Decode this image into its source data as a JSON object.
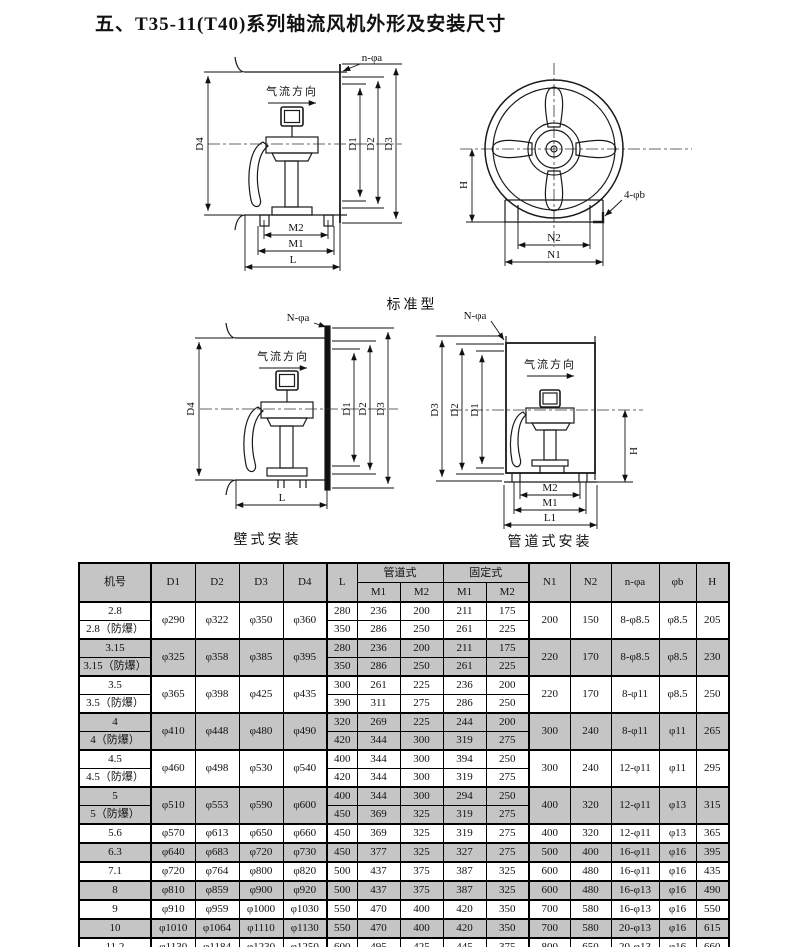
{
  "title": "五、T35-11(T40)系列轴流风机外形及安装尺寸",
  "colors": {
    "table_shade": "#c5c5c5",
    "line": "#111111"
  },
  "diagrams": {
    "airflow": "气流方向",
    "standard_caption": "标准型",
    "wall_caption": "壁式安装",
    "duct_caption": "管道式安装",
    "side": {
      "holes": "n-φa",
      "d4": "D4",
      "d1": "D1",
      "d2": "D2",
      "d3": "D3",
      "m2": "M2",
      "m1": "M1",
      "l": "L"
    },
    "front": {
      "holes": "4-φb",
      "h": "H",
      "n2": "N2",
      "n1": "N1"
    },
    "wall": {
      "holes": "N-φa",
      "d4": "D4",
      "d1": "D1",
      "d2": "D2",
      "d3": "D3",
      "l": "L"
    },
    "duct": {
      "holes": "N-φa",
      "d3": "D3",
      "d2": "D2",
      "d1": "D1",
      "h": "H",
      "m2": "M2",
      "m1": "M1",
      "l1": "L1"
    }
  },
  "table": {
    "headers": {
      "model": "机号",
      "d1": "D1",
      "d2": "D2",
      "d3": "D3",
      "d4": "D4",
      "l": "L",
      "duct": "管道式",
      "fixed": "固定式",
      "m1": "M1",
      "m2": "M2",
      "n1": "N1",
      "n2": "N2",
      "na": "n-φa",
      "b": "φb",
      "h": "H"
    },
    "groups": [
      {
        "names": [
          "2.8",
          "2.8（防爆）"
        ],
        "dims": [
          "φ290",
          "φ322",
          "φ350",
          "φ360"
        ],
        "sub": [
          [
            "280",
            "236",
            "200",
            "211",
            "175"
          ],
          [
            "350",
            "286",
            "250",
            "261",
            "225"
          ]
        ],
        "tail": [
          "200",
          "150",
          "8-φ8.5",
          "φ8.5",
          "205"
        ],
        "shaded": false
      },
      {
        "names": [
          "3.15",
          "3.15（防爆）"
        ],
        "dims": [
          "φ325",
          "φ358",
          "φ385",
          "φ395"
        ],
        "sub": [
          [
            "280",
            "236",
            "200",
            "211",
            "175"
          ],
          [
            "350",
            "286",
            "250",
            "261",
            "225"
          ]
        ],
        "tail": [
          "220",
          "170",
          "8-φ8.5",
          "φ8.5",
          "230"
        ],
        "shaded": true
      },
      {
        "names": [
          "3.5",
          "3.5（防爆）"
        ],
        "dims": [
          "φ365",
          "φ398",
          "φ425",
          "φ435"
        ],
        "sub": [
          [
            "300",
            "261",
            "225",
            "236",
            "200"
          ],
          [
            "390",
            "311",
            "275",
            "286",
            "250"
          ]
        ],
        "tail": [
          "220",
          "170",
          "8-φ11",
          "φ8.5",
          "250"
        ],
        "shaded": false
      },
      {
        "names": [
          "4",
          "4（防爆）"
        ],
        "dims": [
          "φ410",
          "φ448",
          "φ480",
          "φ490"
        ],
        "sub": [
          [
            "320",
            "269",
            "225",
            "244",
            "200"
          ],
          [
            "420",
            "344",
            "300",
            "319",
            "275"
          ]
        ],
        "tail": [
          "300",
          "240",
          "8-φ11",
          "φ11",
          "265"
        ],
        "shaded": true
      },
      {
        "names": [
          "4.5",
          "4.5（防爆）"
        ],
        "dims": [
          "φ460",
          "φ498",
          "φ530",
          "φ540"
        ],
        "sub": [
          [
            "400",
            "344",
            "300",
            "394",
            "250"
          ],
          [
            "420",
            "344",
            "300",
            "319",
            "275"
          ]
        ],
        "tail": [
          "300",
          "240",
          "12-φ11",
          "φ11",
          "295"
        ],
        "shaded": false
      },
      {
        "names": [
          "5",
          "5（防爆）"
        ],
        "dims": [
          "φ510",
          "φ553",
          "φ590",
          "φ600"
        ],
        "sub": [
          [
            "400",
            "344",
            "300",
            "294",
            "250"
          ],
          [
            "450",
            "369",
            "325",
            "319",
            "275"
          ]
        ],
        "tail": [
          "400",
          "320",
          "12-φ11",
          "φ13",
          "315"
        ],
        "shaded": true
      },
      {
        "names": [
          "5.6"
        ],
        "dims": [
          "φ570",
          "φ613",
          "φ650",
          "φ660"
        ],
        "sub": [
          [
            "450",
            "369",
            "325",
            "319",
            "275"
          ]
        ],
        "tail": [
          "400",
          "320",
          "12-φ11",
          "φ13",
          "365"
        ],
        "shaded": false
      },
      {
        "names": [
          "6.3"
        ],
        "dims": [
          "φ640",
          "φ683",
          "φ720",
          "φ730"
        ],
        "sub": [
          [
            "450",
            "377",
            "325",
            "327",
            "275"
          ]
        ],
        "tail": [
          "500",
          "400",
          "16-φ11",
          "φ16",
          "395"
        ],
        "shaded": true
      },
      {
        "names": [
          "7.1"
        ],
        "dims": [
          "φ720",
          "φ764",
          "φ800",
          "φ820"
        ],
        "sub": [
          [
            "500",
            "437",
            "375",
            "387",
            "325"
          ]
        ],
        "tail": [
          "600",
          "480",
          "16-φ11",
          "φ16",
          "435"
        ],
        "shaded": false
      },
      {
        "names": [
          "8"
        ],
        "dims": [
          "φ810",
          "φ859",
          "φ900",
          "φ920"
        ],
        "sub": [
          [
            "500",
            "437",
            "375",
            "387",
            "325"
          ]
        ],
        "tail": [
          "600",
          "480",
          "16-φ13",
          "φ16",
          "490"
        ],
        "shaded": true
      },
      {
        "names": [
          "9"
        ],
        "dims": [
          "φ910",
          "φ959",
          "φ1000",
          "φ1030"
        ],
        "sub": [
          [
            "550",
            "470",
            "400",
            "420",
            "350"
          ]
        ],
        "tail": [
          "700",
          "580",
          "16-φ13",
          "φ16",
          "550"
        ],
        "shaded": false
      },
      {
        "names": [
          "10"
        ],
        "dims": [
          "φ1010",
          "φ1064",
          "φ1110",
          "φ1130"
        ],
        "sub": [
          [
            "550",
            "470",
            "400",
            "420",
            "350"
          ]
        ],
        "tail": [
          "700",
          "580",
          "20-φ13",
          "φ16",
          "615"
        ],
        "shaded": true
      },
      {
        "names": [
          "11.2"
        ],
        "dims": [
          "φ1130",
          "φ1184",
          "φ1230",
          "φ1250"
        ],
        "sub": [
          [
            "600",
            "495",
            "425",
            "445",
            "375"
          ]
        ],
        "tail": [
          "800",
          "650",
          "20-φ13",
          "φ16",
          "660"
        ],
        "shaded": false
      }
    ]
  }
}
